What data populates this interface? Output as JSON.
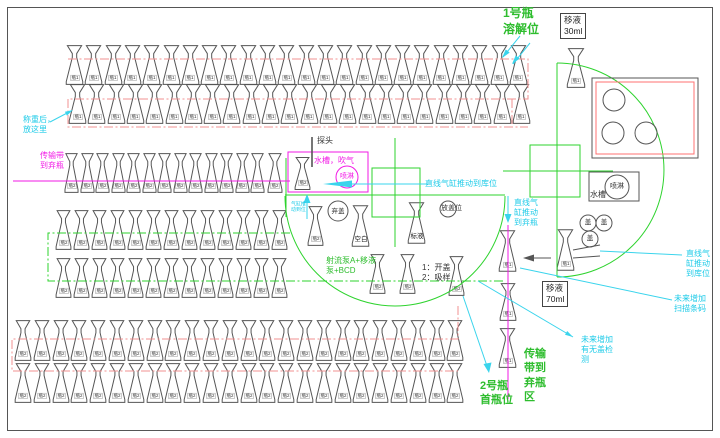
{
  "diagram": {
    "palette": {
      "green": "#2ebd2e",
      "magenta": "#f21ae6",
      "cyan": "#1ecbe8",
      "red_path": "#f29090",
      "line_black": "#555555"
    },
    "flask_rows": [
      {
        "name": "bottle1-row-1",
        "label": "瓶1",
        "count": 24,
        "x": 65,
        "y": 45,
        "pitch": 19.3,
        "w": 19,
        "h": 40
      },
      {
        "name": "bottle1-row-2",
        "label": "瓶1",
        "count": 24,
        "x": 68,
        "y": 84,
        "pitch": 19.3,
        "w": 19,
        "h": 40
      },
      {
        "name": "bottle2-conveyor-row",
        "label": "瓶2",
        "count": 13,
        "x": 64,
        "y": 153,
        "pitch": 15.5,
        "w": 15,
        "h": 40
      },
      {
        "name": "bottle2-conveyor-single",
        "label": "瓶2",
        "count": 1,
        "x": 267,
        "y": 153,
        "pitch": 16,
        "w": 16,
        "h": 40
      },
      {
        "name": "bottle2-mid-row-1",
        "label": "瓶2",
        "count": 13,
        "x": 55,
        "y": 210,
        "pitch": 18,
        "w": 17,
        "h": 40
      },
      {
        "name": "bottle2-mid-row-2",
        "label": "瓶2",
        "count": 13,
        "x": 55,
        "y": 258,
        "pitch": 18,
        "w": 17,
        "h": 40
      },
      {
        "name": "bottle2-bottom-row-1",
        "label": "瓶2",
        "count": 24,
        "x": 14,
        "y": 320,
        "pitch": 18.8,
        "w": 18,
        "h": 41
      },
      {
        "name": "bottle2-bottom-row-2",
        "label": "瓶2",
        "count": 24,
        "x": 14,
        "y": 363,
        "pitch": 18.8,
        "w": 18,
        "h": 40
      }
    ],
    "flasks": [
      {
        "name": "wash-station-flask",
        "label": "瓶2",
        "x": 294,
        "y": 157,
        "w": 17,
        "h": 33
      },
      {
        "name": "dissolve-position-flask",
        "label": "瓶1",
        "x": 566,
        "y": 48,
        "w": 20,
        "h": 40
      },
      {
        "name": "turntable-bottle2-flask",
        "label": "瓶2",
        "x": 307,
        "y": 206,
        "w": 17,
        "h": 40
      },
      {
        "name": "blank-flask",
        "label": "空白",
        "x": 351,
        "y": 205,
        "w": 19,
        "h": 42,
        "big": true
      },
      {
        "name": "standard-solution-flask",
        "label": "标液",
        "x": 407,
        "y": 202,
        "w": 19,
        "h": 42,
        "big": true
      },
      {
        "name": "pump-flask-1",
        "label": "瓶2",
        "x": 369,
        "y": 254,
        "w": 17,
        "h": 40
      },
      {
        "name": "pump-flask-2",
        "label": "瓶2",
        "x": 399,
        "y": 254,
        "w": 17,
        "h": 40
      },
      {
        "name": "sampling-flask",
        "label": "瓶2",
        "x": 448,
        "y": 256,
        "w": 17,
        "h": 40
      },
      {
        "name": "discard-chain-flask-1",
        "label": "瓶1",
        "x": 498,
        "y": 230,
        "w": 19,
        "h": 42
      },
      {
        "name": "push-in-flask",
        "label": "瓶1",
        "x": 556,
        "y": 229,
        "w": 19,
        "h": 42
      },
      {
        "name": "discard-chain-flask-2",
        "label": "瓶1",
        "x": 499,
        "y": 283,
        "w": 18,
        "h": 38
      },
      {
        "name": "discard-chain-flask-3",
        "label": "瓶1",
        "x": 498,
        "y": 328,
        "w": 19,
        "h": 40
      }
    ],
    "stations": {
      "pipette_30": {
        "line1": "移液",
        "line2": "30ml"
      },
      "pipette_70": {
        "line1": "移液",
        "line2": "70ml"
      },
      "probe": "探头",
      "wash_left_label": "水槽，吹气",
      "spray_left": "喷淋",
      "wash_right_label": "水槽",
      "spray_right": "喷淋",
      "cap1": "盖",
      "cap2": "盖",
      "cap3": "盖",
      "discard_cap": "弃盖",
      "place_cap": "放盖位",
      "open_aspirate": {
        "line1": "1：开盖",
        "line2": "2：吸样"
      },
      "jet_pump": {
        "line1": "射流泵A+移液",
        "line2": "泵+BCD"
      }
    },
    "annotations": {
      "weigh_note": {
        "line1": "称重后，",
        "line2": "放这里"
      },
      "conveyor_discard_left": {
        "line1": "传输带",
        "line2": "到弃瓶"
      },
      "bottle1_dissolve": {
        "line1": "1号瓶",
        "line2": "溶解位"
      },
      "cyl_push_storage_mid": {
        "line1": "直线气缸推动到库位"
      },
      "cyl_push_small": {
        "line1": "气缸推",
        "line2": "动到位"
      },
      "cyl_push_discard": {
        "line1": "直线气",
        "line2": "缸推动",
        "line3": "到弃瓶"
      },
      "cyl_push_storage_right": {
        "line1": "直线气",
        "line2": "缸推动",
        "line3": "到库位"
      },
      "future_barcode": {
        "line1": "未来增加",
        "line2": "扫描条码"
      },
      "future_cap_detect": {
        "line1": "未来增加",
        "line2": "有无盖检",
        "line3": "测"
      },
      "conveyor_discard_area": {
        "line1": "传输",
        "line2": "带到",
        "line3": "弃瓶",
        "line4": "区"
      },
      "bottle2_first": {
        "line1": "2号瓶",
        "line2": "首瓶位"
      }
    }
  }
}
